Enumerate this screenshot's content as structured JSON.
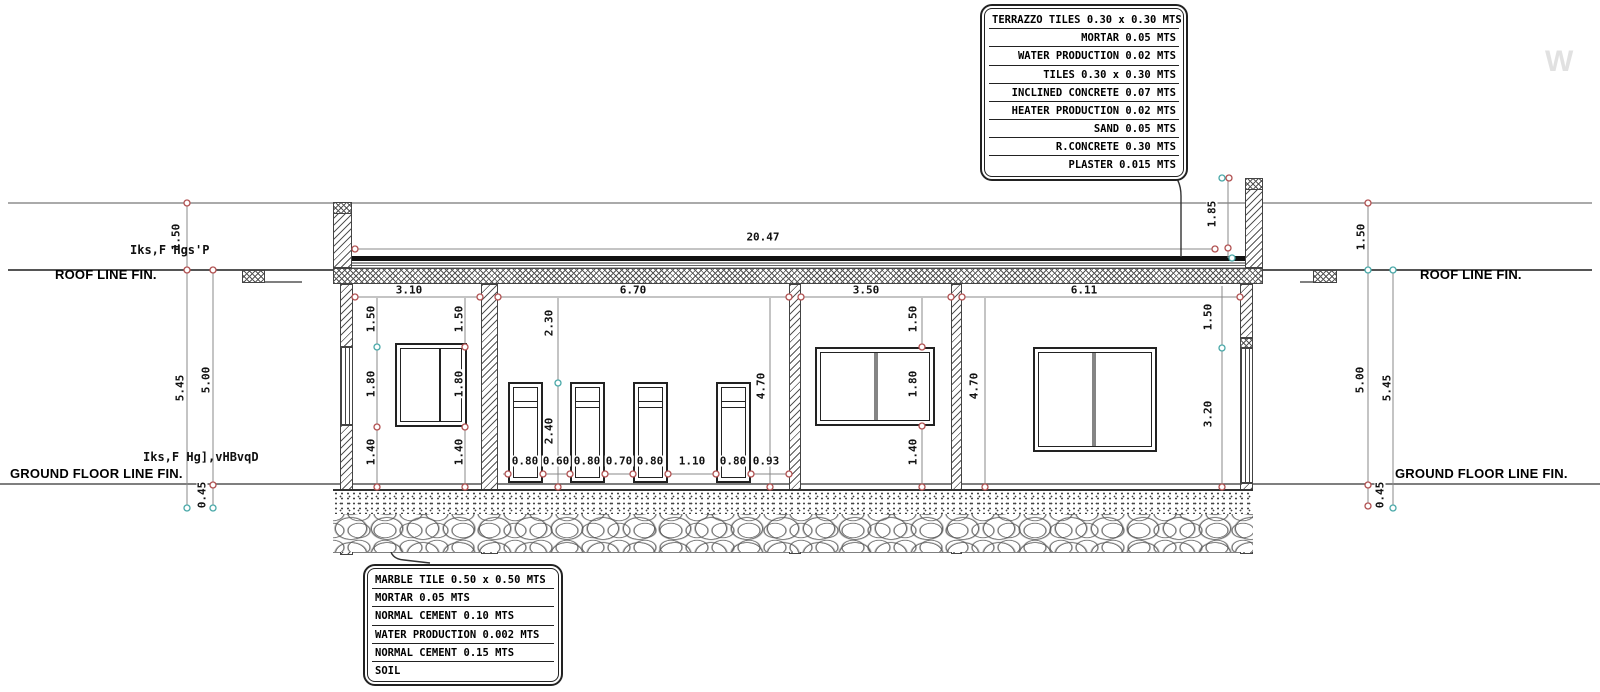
{
  "drawing": {
    "type": "building-section-elevation",
    "labels": {
      "roof_line": "ROOF LINE FIN.",
      "ground_line": "GROUND FLOOR LINE FIN.",
      "note_roof": "Iks,F  Hgs'P",
      "note_ground": "Iks,F  Hg],vHBvqD",
      "watermark": "W"
    }
  },
  "callout_roof": {
    "lines": [
      "TERRAZZO TILES 0.30 x 0.30 MTS",
      "MORTAR 0.05 MTS",
      "WATER PRODUCTION 0.02 MTS",
      "TILES 0.30 x 0.30 MTS",
      "INCLINED CONCRETE  0.07 MTS",
      "HEATER PRODUCTION 0.02 MTS",
      "SAND 0.05 MTS",
      "R.CONCRETE 0.30 MTS",
      "PLASTER 0.015 MTS"
    ]
  },
  "callout_floor": {
    "lines": [
      "MARBLE TILE 0.50 x 0.50 MTS",
      "MORTAR 0.05 MTS",
      "NORMAL CEMENT 0.10 MTS",
      "WATER PRODUCTION 0.002 MTS",
      "NORMAL CEMENT 0.15 MTS",
      "SOIL"
    ]
  },
  "dims": {
    "overall_width": "20.47",
    "bays": [
      "3.10",
      "6.70",
      "3.50",
      "6.11"
    ],
    "door_row": [
      "0.80",
      "0.60",
      "0.80",
      "0.70",
      "0.80",
      "1.10",
      "0.80",
      "0.93"
    ],
    "v150": "1.50",
    "v180": "1.80",
    "v140": "1.40",
    "v230": "2.30",
    "v240": "2.40",
    "v470": "4.70",
    "v320": "3.20",
    "v185": "1.85",
    "v545": "5.45",
    "v500": "5.00",
    "v045": "0.45"
  }
}
